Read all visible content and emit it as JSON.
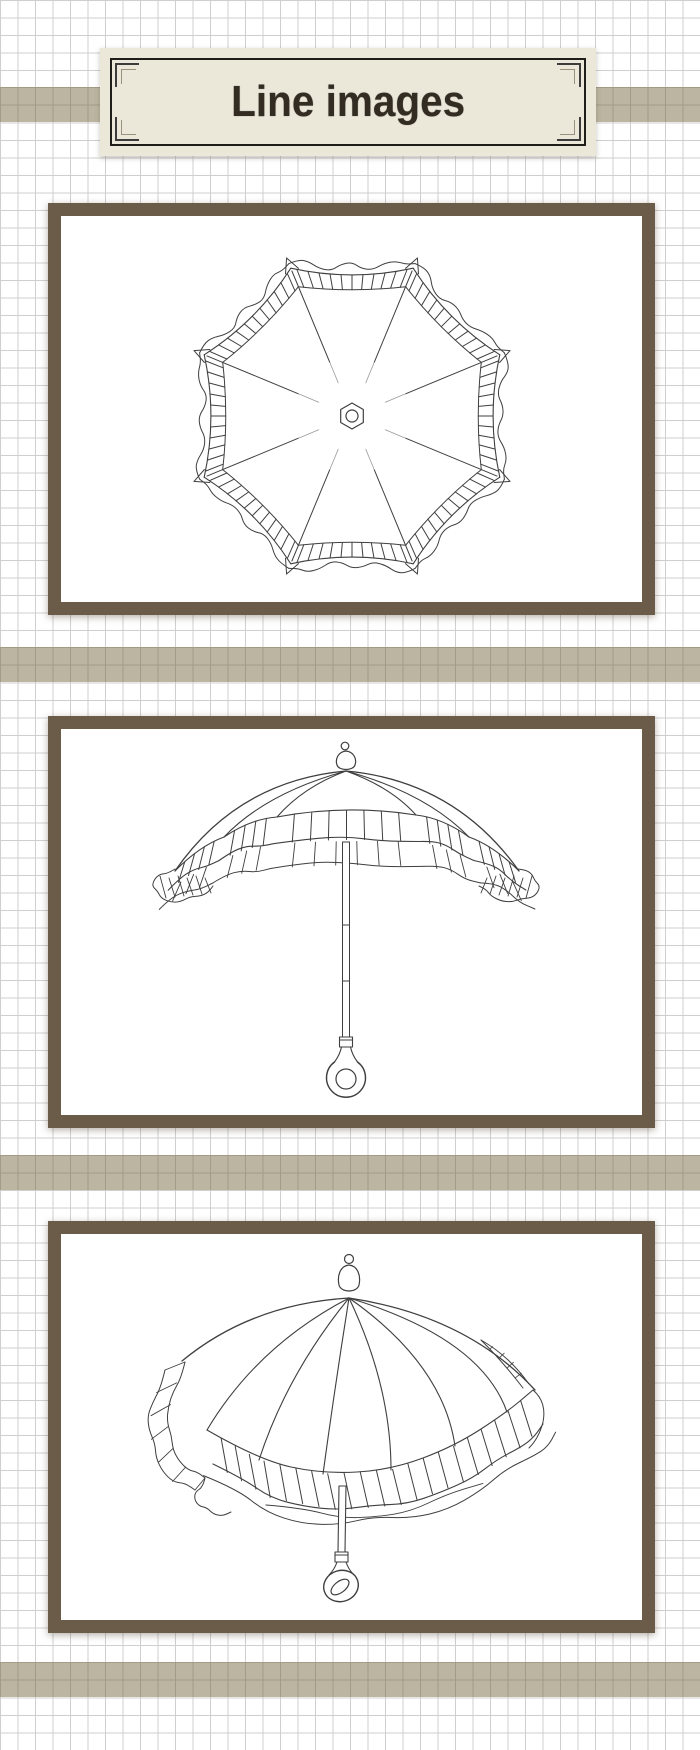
{
  "header": {
    "title": "Line images"
  },
  "gallery": {
    "items": [
      {
        "name": "parasol-top-view",
        "alt": "Line drawing of a frilled parasol viewed from above: eight panels, striped ruffle border, hexagonal hub"
      },
      {
        "name": "parasol-side-view",
        "alt": "Line drawing of a frilled parasol viewed from the side: domed canopy, striped double ruffle, straight shaft with ring handle"
      },
      {
        "name": "parasol-three-quarter-view",
        "alt": "Line drawing of a frilled parasol viewed from a three-quarter angle: tilted canopy, striped ruffle skirt, ring handle"
      }
    ]
  },
  "colors": {
    "paper": "#ffffff",
    "gridline": "#cfcfcf",
    "band": "#bcb5a2",
    "bandline": "#a39b86",
    "frame": "#6b5b49",
    "plate": "#ebe8da",
    "plateborder": "#1f1d19",
    "ink": "#3f3f3f",
    "title": "#332c23"
  }
}
